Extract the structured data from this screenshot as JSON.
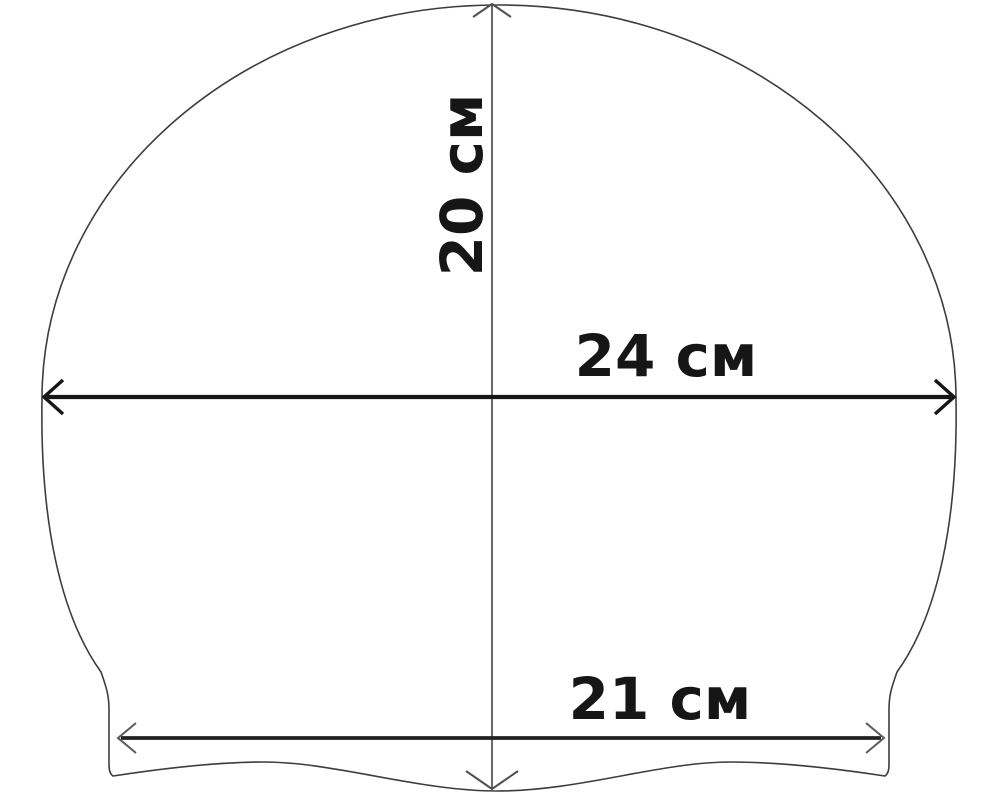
{
  "title": "Swim cap dimension diagram",
  "canvas": {
    "width_px": 1000,
    "height_px": 796,
    "background": "#ffffff"
  },
  "colors": {
    "outline": "#3d3d3d",
    "bold_dimension": "#161616",
    "mid_dimension": "#222222",
    "thin_dimension": "#4f4f4f",
    "label_text": "#161616"
  },
  "diagram": {
    "subject": "swim-cap",
    "style": "technical line drawing with open V arrowheads",
    "dimensions": {
      "height": {
        "label": "20 см",
        "value": "20",
        "unit": "см",
        "orientation": "vertical",
        "description": "cap height, top of dome to bottom hem center"
      },
      "width": {
        "label": "24 см",
        "value": "24",
        "unit": "см",
        "orientation": "horizontal",
        "description": "cap width at widest point"
      },
      "brim_width": {
        "label": "21 см",
        "value": "21",
        "unit": "см",
        "orientation": "horizontal",
        "description": "width of bottom hem band"
      }
    }
  }
}
